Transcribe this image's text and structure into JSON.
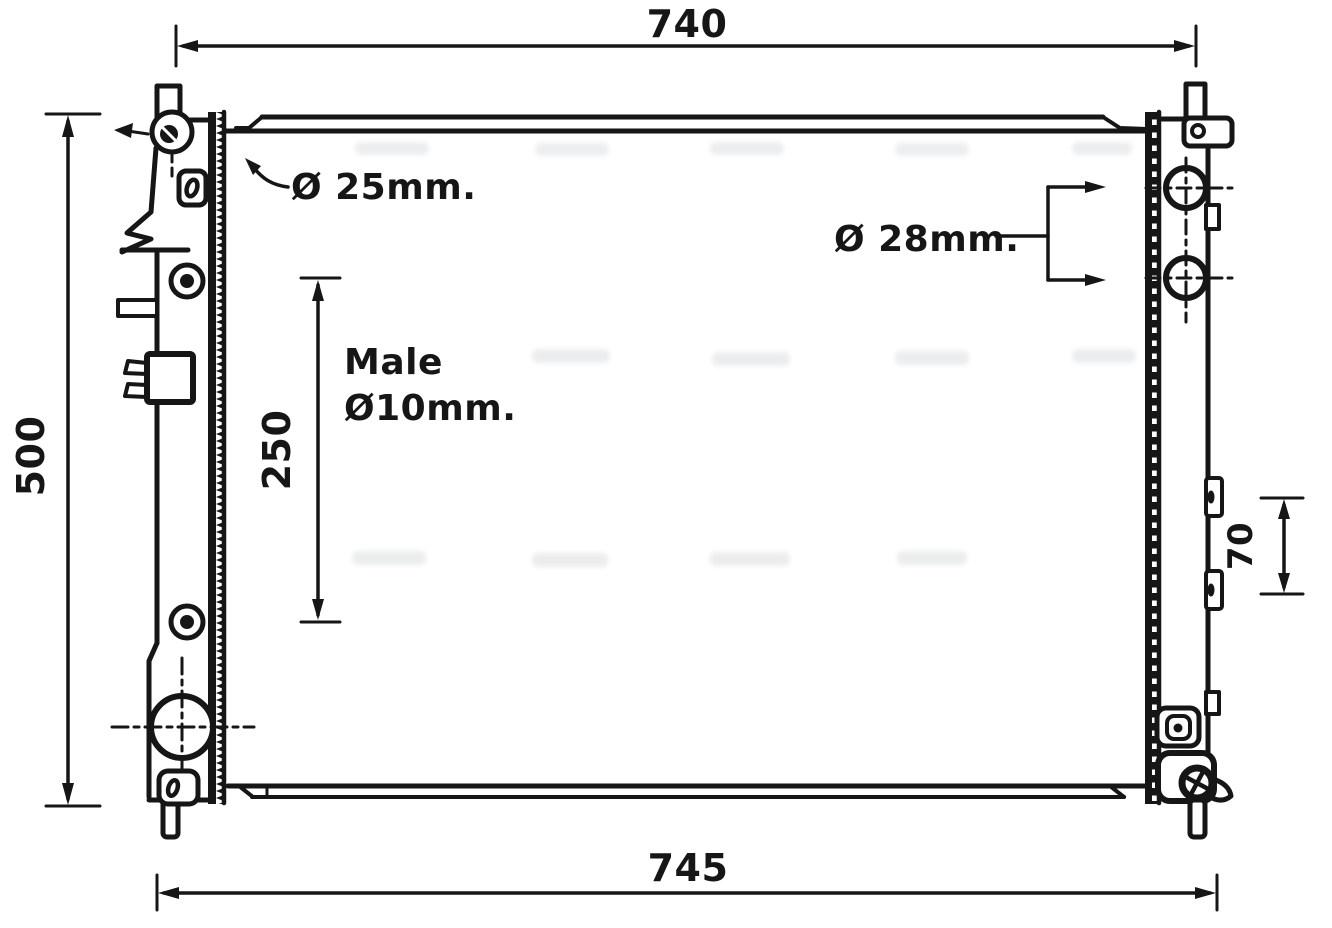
{
  "drawing": {
    "ink_color": "#161616",
    "paper_color": "#ffffff",
    "dimensions": {
      "top_width": "740",
      "bottom_width": "745",
      "left_height": "500",
      "inlet_span": "250",
      "right_tab_spacing": "70"
    },
    "callouts": {
      "top_inlet_diameter": "Ø 25mm.",
      "right_ports_diameter": "Ø 28mm.",
      "connector_type": "Male",
      "connector_diameter": "Ø10mm."
    }
  }
}
